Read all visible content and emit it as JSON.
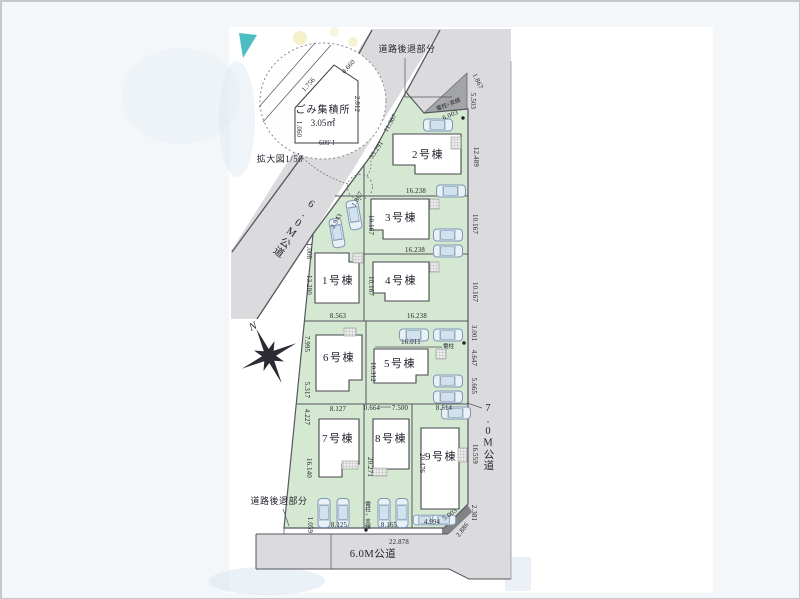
{
  "plan": {
    "scale_note": "拡大図1/50",
    "north_label": "N",
    "garbage": {
      "name": "ごみ集積所",
      "area": "3.05㎡",
      "dim_slope": "1.756",
      "dim_top": "0.660",
      "dim_right": "2.812",
      "dim_left": "1.060",
      "dim_bottom": "1.609"
    },
    "setback_top": "道路後退部分",
    "setback_bottom": "道路後退部分",
    "pole_guy_top": "電柱+支線",
    "pole_right": "電柱",
    "pole_guy_bottom": "電柱+支線",
    "roads": {
      "diagonal": "6.0M公道",
      "right": "7.0M公道",
      "bottom": "6.0M公道"
    },
    "lots": {
      "l1": "1号棟",
      "l2": "2号棟",
      "l3": "3号棟",
      "l4": "4号棟",
      "l5": "5号棟",
      "l6": "6号棟",
      "l7": "7号棟",
      "l8": "8号棟",
      "l9": "9号棟"
    },
    "dims": {
      "d6003": "6.003",
      "d1867": "1.867",
      "d5503": "5.503",
      "d35291": "35.291",
      "d11367": "11.367",
      "d12489": "12.489",
      "d16238": "16.238",
      "d10167": "10.167",
      "d2943": "2.943",
      "d1006": "1.006",
      "d13280": "13.280",
      "d8563": "8.563",
      "d7995": "7.995",
      "d5317": "5.317",
      "d16011": "16.011",
      "d10312": "10.312",
      "d3001": "3.001",
      "d4647": "4.647",
      "d5665": "5.665",
      "d8127": "8.127",
      "d0664": "0.664",
      "d7500": "7.500",
      "d8514": "8.514",
      "d4227": "4.227",
      "d16140": "16.140",
      "d20271": "20.271",
      "d20476": "20.476",
      "d16559": "16.559",
      "d8125": "8.125",
      "d8165": "8.165",
      "d4994": "4.994",
      "d5003": "5.003",
      "d2886": "2.886",
      "d2381": "2.381",
      "d1059": "1.059",
      "d22878": "22.878"
    }
  }
}
